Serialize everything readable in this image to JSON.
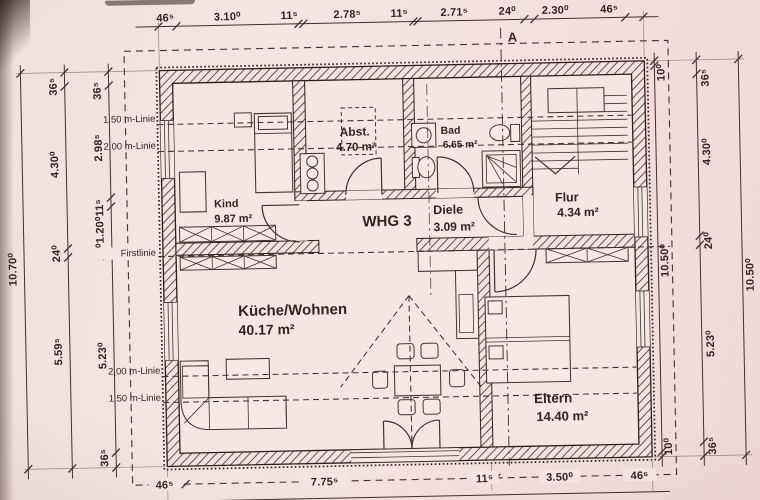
{
  "photo": {
    "paper_color": "#f4e3e1",
    "ink_color": "#42302b"
  },
  "dims": {
    "top": [
      "46⁵",
      "3.10⁰",
      "11⁵",
      "2.78⁵",
      "11⁵",
      "2.71⁵",
      "24⁰",
      "2.30⁰",
      "46⁵"
    ],
    "bottom": [
      "46⁵",
      "7.75⁵",
      "11⁵",
      "3.50⁰",
      "46⁵"
    ],
    "left_outer": "10.70⁰",
    "left_mid": [
      "36⁵",
      "4.30⁰",
      "24⁰",
      "5.59⁵"
    ],
    "left_inner": [
      "36⁵",
      "2.98⁵",
      "24⁰1.20⁰11⁵",
      "5.23⁰",
      "36⁵"
    ],
    "right_inner": [
      "10⁰",
      "10.50⁰",
      "10⁰"
    ],
    "right_mid": [
      "36⁵",
      "4.30⁰",
      "24⁰",
      "5.23⁰",
      "36⁵"
    ],
    "right_outer": "10.50⁰"
  },
  "levels": {
    "line150_top": "1.50 m-Linie",
    "line200_top": "2.00 m-Linie",
    "first": "Firstlinie",
    "line200_bottom": "2,00 m-Linie",
    "line150_bottom": "1,50 m-Linie"
  },
  "section": {
    "label": "A"
  },
  "rooms": {
    "kind": {
      "name": "Kind",
      "area": "9.87 m²"
    },
    "abst": {
      "name": "Abst.",
      "area": "4.70 m²"
    },
    "bad": {
      "name": "Bad",
      "area": "6.65 m²"
    },
    "flur": {
      "name": "Flur",
      "area": "4.34 m²"
    },
    "diele": {
      "name": "Diele",
      "area": "3.09 m²"
    },
    "whg": {
      "label": "WHG 3"
    },
    "kueche": {
      "name": "Küche/Wohnen",
      "area": "40.17 m²"
    },
    "eltern": {
      "name": "Eltern",
      "area": "14.40 m²"
    }
  }
}
